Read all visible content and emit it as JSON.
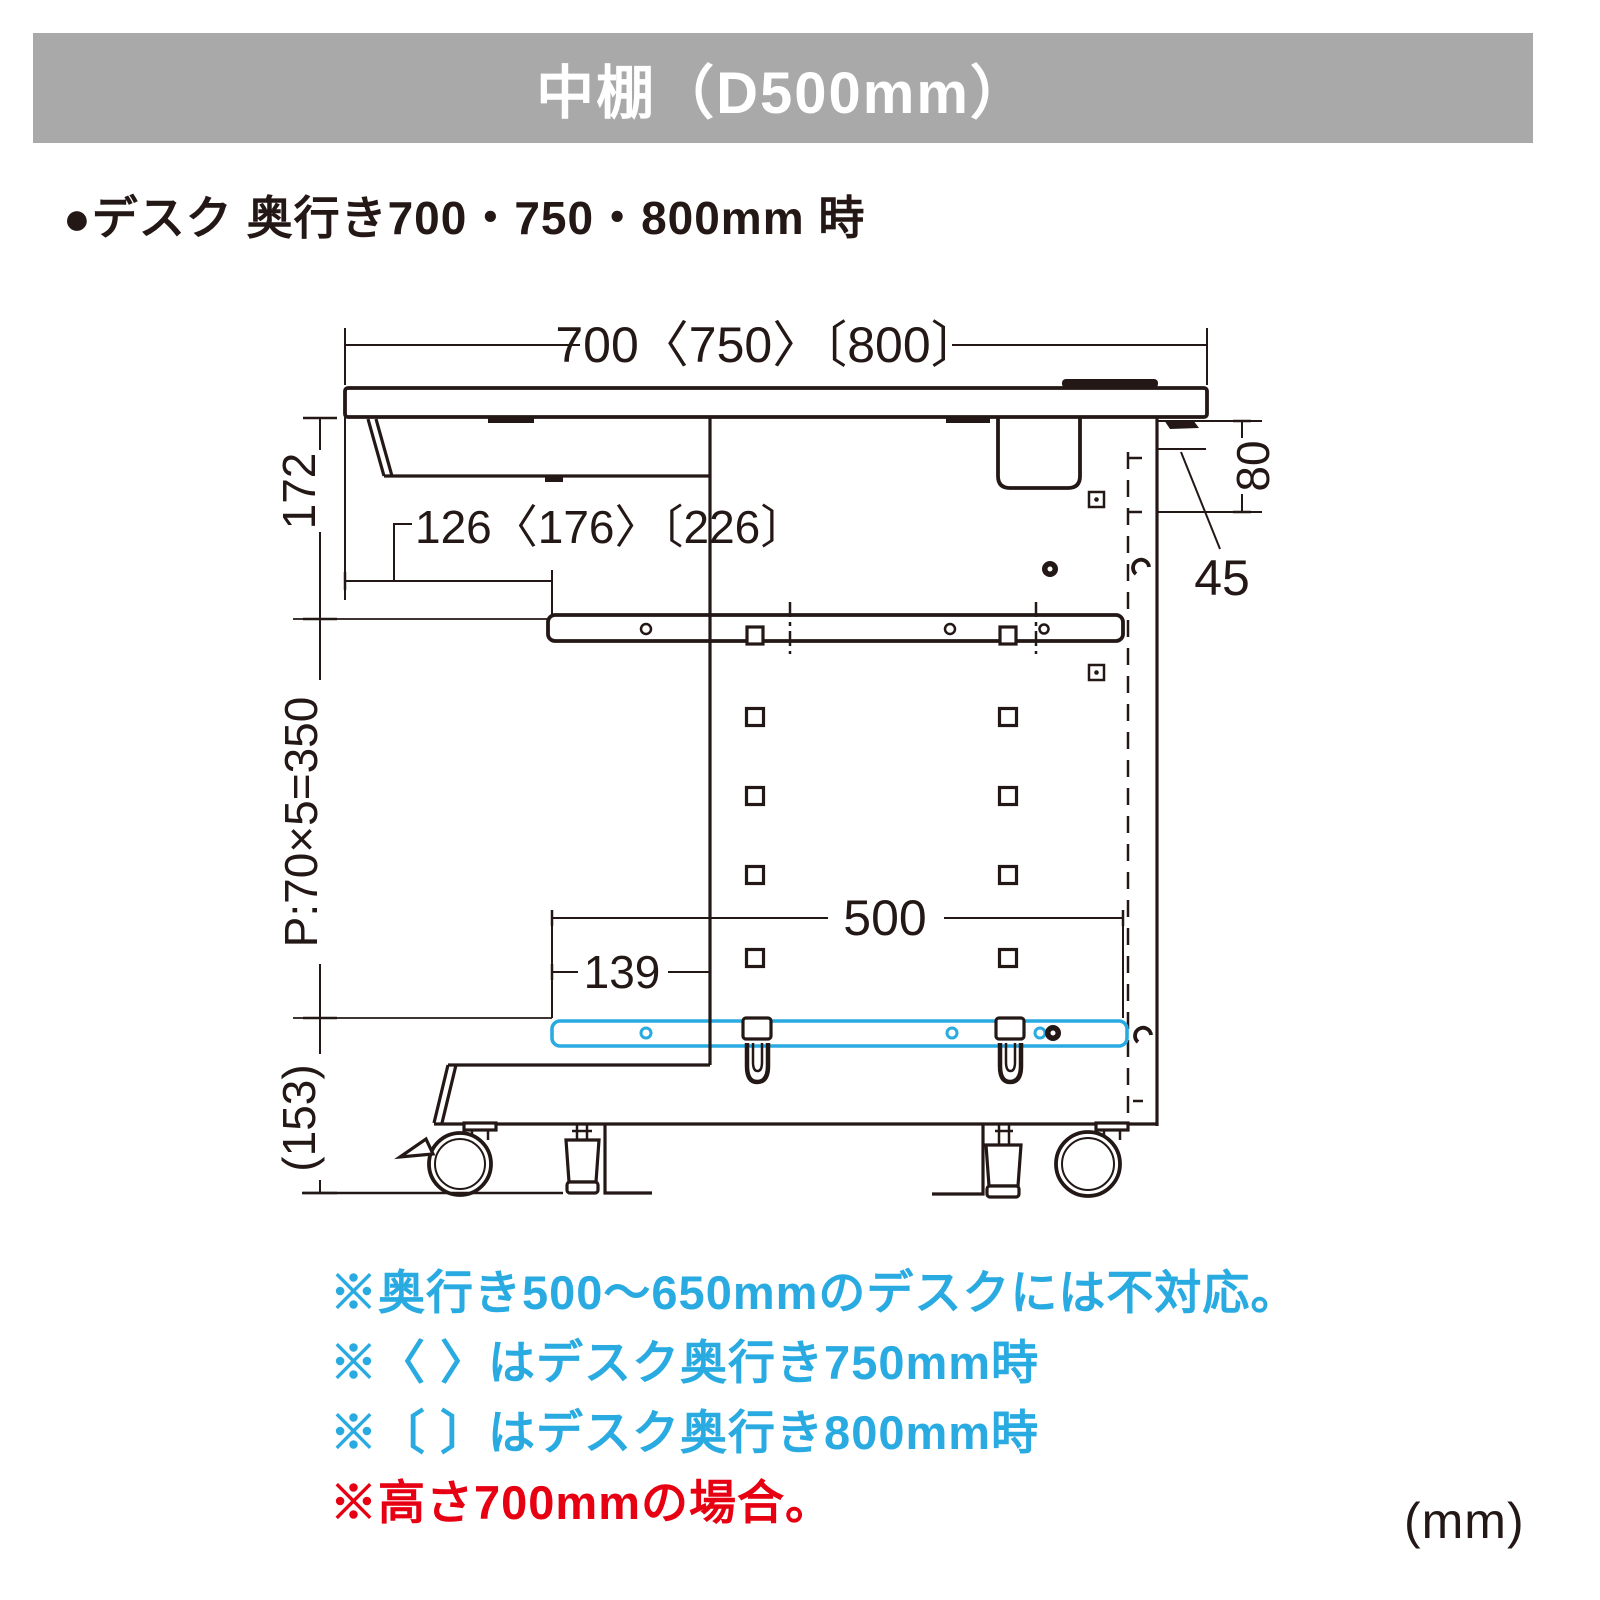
{
  "header": {
    "title": "中棚（D500mm）",
    "bg_color": "#a9a9a9",
    "text_color": "#ffffff"
  },
  "subtitle": {
    "text": "●デスク 奥行き700・750・800mm 時"
  },
  "diagram": {
    "line_color": "#231815",
    "highlight_color": "#29abe2",
    "dims": {
      "desk_depth": "700〈750〉〔800〕",
      "tray_offset": "126〈176〉〔226〕",
      "under_top": "172",
      "hole_pitch": "P:70×5=350",
      "base_height": "(153)",
      "rear_gap": "80",
      "rear_offset": "45",
      "shelf_depth": "500",
      "shelf_front_offset": "139"
    }
  },
  "notes": [
    {
      "text": "※奥行き500〜650mmのデスクには不対応。",
      "color": "#29abe2"
    },
    {
      "text": "※〈 〉はデスク奥行き750mm時",
      "color": "#29abe2"
    },
    {
      "text": "※〔 〕はデスク奥行き800mm時",
      "color": "#29abe2"
    },
    {
      "text": "※高さ700mmの場合。",
      "color": "#e60012"
    }
  ],
  "page": {
    "unit_label": "(mm)"
  }
}
